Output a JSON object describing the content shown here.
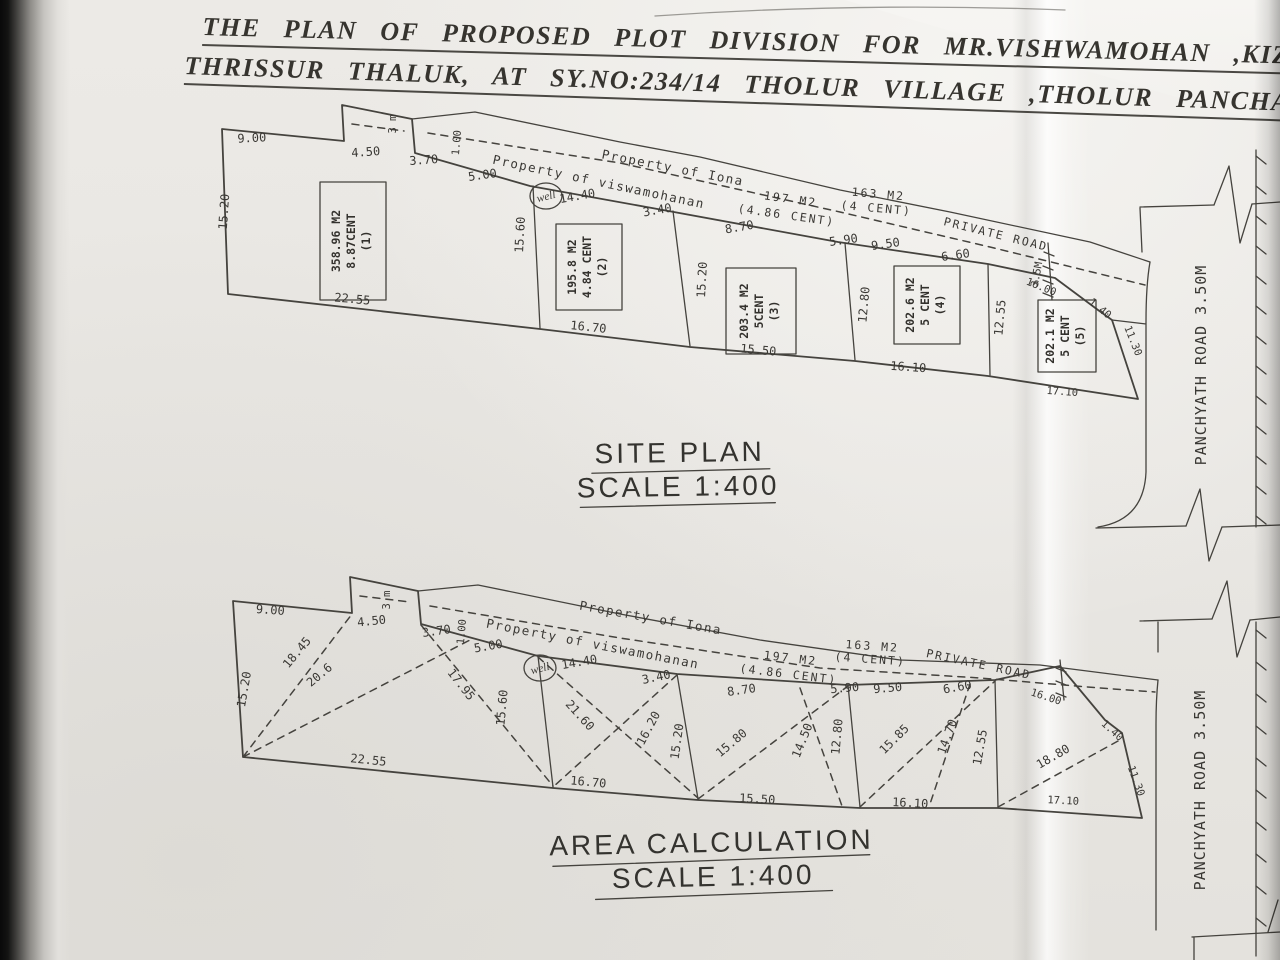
{
  "document": {
    "title_line1": "THE PLAN OF PROPOSED PLOT DIVISION FOR MR.VISHWAMOHAN ,KIZH",
    "title_line2": "THRISSUR THALUK, AT SY.NO:234/14 THOLUR VILLAGE ,THOLUR PANCHA"
  },
  "plan_labels": {
    "iona": "Property of Iona",
    "viswamohanan": "Property of viswamohanan",
    "private_road": "PRIVATE ROAD",
    "well": "well",
    "p197_area": "197  M2",
    "p197_cent": "(4.86 CENT)",
    "p163_area": "163  M2",
    "p163_cent": "(4 CENT)",
    "lane_width": "3 m",
    "lane_len": "1.00",
    "road_width": "3.5M"
  },
  "boundary_dims": {
    "top1": "9.00",
    "top2": "4.50",
    "top3": "3.70",
    "top4": "5.00",
    "top5": "14.40",
    "top6": "3.40",
    "top7": "8.70",
    "top8": "5.90",
    "top9": "9.50",
    "top10": "6.60",
    "diag16": "16.00",
    "diag140": "1.40",
    "right": "11.30",
    "left": "15.20",
    "div1": "15.60",
    "div2": "15.20",
    "div3": "12.80",
    "div4": "12.55",
    "bot1": "22.55",
    "bot2": "16.70",
    "bot3": "15.50",
    "bot4": "16.10",
    "bot5": "17.10"
  },
  "site_plan": {
    "heading": "SITE PLAN",
    "scale": "SCALE 1:400",
    "plots": [
      {
        "area": "358.96 M2",
        "cent": "8.87CENT",
        "num": "(1)"
      },
      {
        "area": "195.8 M2",
        "cent": "4.84 CENT",
        "num": "(2)"
      },
      {
        "area": "203.4 M2",
        "cent": "5CENT",
        "num": "(3)"
      },
      {
        "area": "202.6 M2",
        "cent": "5 CENT",
        "num": "(4)"
      },
      {
        "area": "202.1 M2",
        "cent": "5 CENT",
        "num": "(5)"
      }
    ]
  },
  "area_calc": {
    "heading": "AREA CALCULATION",
    "scale": "SCALE 1:400",
    "diagonals": {
      "d1": "18.45",
      "d2": "20.6",
      "d3": "17.95",
      "d4": "21.60",
      "d5": "16.20",
      "d6": "15.80",
      "d7": "14.50",
      "d8": "15.85",
      "d9": "14.70",
      "d10": "18.80"
    }
  },
  "panchyath_road": {
    "label": "PANCHYATH ROAD 3.50M"
  }
}
